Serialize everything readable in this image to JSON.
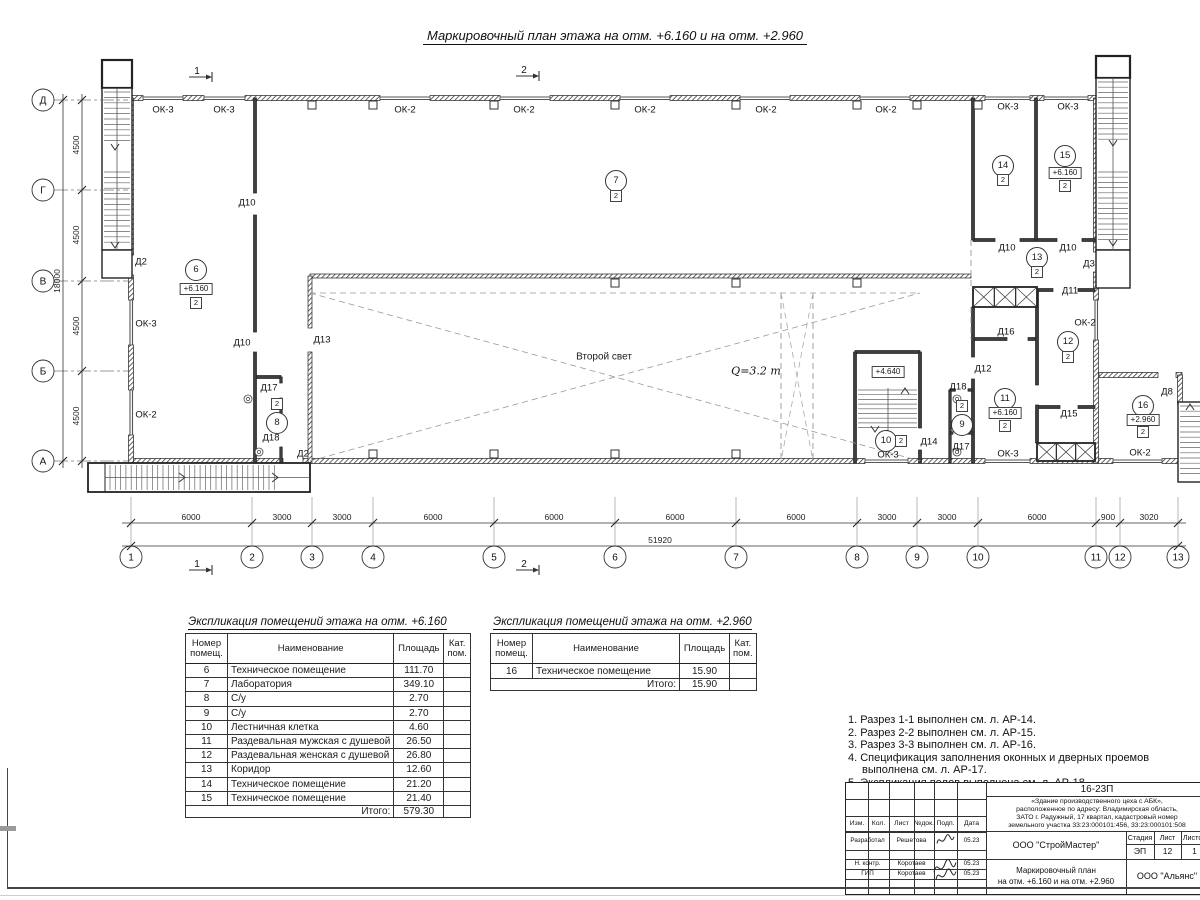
{
  "title": "Маркировочный план этажа на отм. +6.160 и на отм. +2.960",
  "plan": {
    "axes_letters": [
      {
        "label": "Д",
        "y": 100
      },
      {
        "label": "Г",
        "y": 190
      },
      {
        "label": "В",
        "y": 281
      },
      {
        "label": "Б",
        "y": 371
      },
      {
        "label": "А",
        "y": 461
      }
    ],
    "axes_numbers": [
      {
        "label": "1",
        "x": 131
      },
      {
        "label": "2",
        "x": 252
      },
      {
        "label": "3",
        "x": 312
      },
      {
        "label": "4",
        "x": 373
      },
      {
        "label": "5",
        "x": 494
      },
      {
        "label": "6",
        "x": 615
      },
      {
        "label": "7",
        "x": 736
      },
      {
        "label": "8",
        "x": 857
      },
      {
        "label": "9",
        "x": 917
      },
      {
        "label": "10",
        "x": 978
      },
      {
        "label": "11",
        "x": 1096
      },
      {
        "label": "12",
        "x": 1120
      },
      {
        "label": "13",
        "x": 1178
      }
    ],
    "h_dims": [
      {
        "label": "6000",
        "x": 191
      },
      {
        "label": "3000",
        "x": 282
      },
      {
        "label": "3000",
        "x": 342
      },
      {
        "label": "6000",
        "x": 433
      },
      {
        "label": "6000",
        "x": 554
      },
      {
        "label": "6000",
        "x": 675
      },
      {
        "label": "6000",
        "x": 796
      },
      {
        "label": "3000",
        "x": 887
      },
      {
        "label": "3000",
        "x": 947
      },
      {
        "label": "6000",
        "x": 1037
      },
      {
        "label": "900",
        "x": 1108
      },
      {
        "label": "3020",
        "x": 1149
      }
    ],
    "total_dim": "51920",
    "v_dims": [
      {
        "label": "4500",
        "y": 145
      },
      {
        "label": "4500",
        "y": 235
      },
      {
        "label": "4500",
        "y": 326
      },
      {
        "label": "4500",
        "y": 416
      }
    ],
    "total_v_dim": "18000",
    "section_marks": [
      {
        "label": "1",
        "x": 197,
        "y": 71
      },
      {
        "label": "2",
        "x": 524,
        "y": 70
      },
      {
        "label": "1",
        "x": 197,
        "y": 564
      },
      {
        "label": "2",
        "x": 524,
        "y": 564
      }
    ],
    "window_labels": [
      {
        "text": "ОК-3",
        "x": 163,
        "y": 110
      },
      {
        "text": "ОК-3",
        "x": 224,
        "y": 110
      },
      {
        "text": "ОК-2",
        "x": 405,
        "y": 110
      },
      {
        "text": "ОК-2",
        "x": 524,
        "y": 110
      },
      {
        "text": "ОК-2",
        "x": 645,
        "y": 110
      },
      {
        "text": "ОК-2",
        "x": 766,
        "y": 110
      },
      {
        "text": "ОК-2",
        "x": 886,
        "y": 110
      },
      {
        "text": "ОК-3",
        "x": 1008,
        "y": 107
      },
      {
        "text": "ОК-3",
        "x": 1068,
        "y": 107
      },
      {
        "text": "ОК-3",
        "x": 146,
        "y": 324
      },
      {
        "text": "ОК-2",
        "x": 146,
        "y": 415
      },
      {
        "text": "ОК-3",
        "x": 888,
        "y": 455
      },
      {
        "text": "ОК-3",
        "x": 1008,
        "y": 454
      },
      {
        "text": "ОК-2",
        "x": 1140,
        "y": 453
      },
      {
        "text": "ОК-2",
        "x": 1085,
        "y": 323
      }
    ],
    "door_labels": [
      {
        "text": "Д2",
        "x": 141,
        "y": 262
      },
      {
        "text": "Д10",
        "x": 247,
        "y": 203
      },
      {
        "text": "Д10",
        "x": 242,
        "y": 343
      },
      {
        "text": "Д13",
        "x": 322,
        "y": 340
      },
      {
        "text": "Д17",
        "x": 269,
        "y": 388
      },
      {
        "text": "Д18",
        "x": 271,
        "y": 438
      },
      {
        "text": "Д2",
        "x": 303,
        "y": 454
      },
      {
        "text": "Д14",
        "x": 929,
        "y": 442
      },
      {
        "text": "Д18",
        "x": 958,
        "y": 387
      },
      {
        "text": "Д17",
        "x": 961,
        "y": 447
      },
      {
        "text": "Д12",
        "x": 983,
        "y": 369
      },
      {
        "text": "Д16",
        "x": 1006,
        "y": 332
      },
      {
        "text": "Д10",
        "x": 1007,
        "y": 248
      },
      {
        "text": "Д10",
        "x": 1068,
        "y": 248
      },
      {
        "text": "Д3",
        "x": 1089,
        "y": 264
      },
      {
        "text": "Д11",
        "x": 1070,
        "y": 291
      },
      {
        "text": "Д15",
        "x": 1069,
        "y": 414
      },
      {
        "text": "Д8",
        "x": 1167,
        "y": 392
      }
    ],
    "rooms": [
      {
        "num": "6",
        "x": 196,
        "y": 270,
        "elev": "+6.160",
        "elev_dy": 19,
        "cat": "2",
        "cat_dy": 33,
        "cat_dx": 0
      },
      {
        "num": "7",
        "x": 616,
        "y": 181,
        "cat": "2",
        "cat_dy": 15,
        "cat_dx": 0
      },
      {
        "num": "8",
        "x": 277,
        "y": 423,
        "cat": "2",
        "cat_dy": -19,
        "cat_dx": 0
      },
      {
        "num": "9",
        "x": 962,
        "y": 425,
        "cat": "2",
        "cat_dy": -19,
        "cat_dx": 0
      },
      {
        "num": "10",
        "x": 886,
        "y": 441,
        "cat": "2",
        "cat_dy": 0,
        "cat_dx": 15
      },
      {
        "num": "11",
        "x": 1005,
        "y": 399,
        "elev": "+6.160",
        "elev_dy": 14,
        "cat": "2",
        "cat_dy": 27,
        "cat_dx": 0
      },
      {
        "num": "12",
        "x": 1068,
        "y": 342,
        "cat": "2",
        "cat_dy": 15,
        "cat_dx": 0
      },
      {
        "num": "13",
        "x": 1037,
        "y": 258,
        "cat": "2",
        "cat_dy": 14,
        "cat_dx": 0
      },
      {
        "num": "14",
        "x": 1003,
        "y": 166,
        "cat": "2",
        "cat_dy": 14,
        "cat_dx": 0
      },
      {
        "num": "15",
        "x": 1065,
        "y": 156,
        "elev": "+6.160",
        "elev_dy": 17,
        "cat": "2",
        "cat_dy": 30,
        "cat_dx": 0
      },
      {
        "num": "16",
        "x": 1143,
        "y": 406,
        "elev": "+2.960",
        "elev_dy": 14,
        "cat": "2",
        "cat_dy": 26,
        "cat_dx": 0
      }
    ],
    "texts": [
      {
        "text": "Второй свет",
        "x": 604,
        "y": 357,
        "style": "plain"
      },
      {
        "text": "Q=3.2 т",
        "x": 756,
        "y": 371,
        "style": "serifit"
      },
      {
        "text": "+4.640",
        "x": 888,
        "y": 372,
        "style": "boxed"
      }
    ]
  },
  "table1": {
    "title": "Экспликация помещений этажа на отм. +6.160",
    "headers": [
      "Номер помещ.",
      "Наименование",
      "Площадь",
      "Кат. пом."
    ],
    "rows": [
      [
        "6",
        "Техническое помещение",
        "111.70",
        ""
      ],
      [
        "7",
        "Лаборатория",
        "349.10",
        ""
      ],
      [
        "8",
        "С/у",
        "2.70",
        ""
      ],
      [
        "9",
        "С/у",
        "2.70",
        ""
      ],
      [
        "10",
        "Лестничная клетка",
        "4.60",
        ""
      ],
      [
        "11",
        "Раздевальная мужская с душевой",
        "26.50",
        ""
      ],
      [
        "12",
        "Раздевальная женская с душевой",
        "26.80",
        ""
      ],
      [
        "13",
        "Коридор",
        "12.60",
        ""
      ],
      [
        "14",
        "Техническое помещение",
        "21.20",
        ""
      ],
      [
        "15",
        "Техническое помещение",
        "21.40",
        ""
      ]
    ],
    "total_label": "Итого:",
    "total_value": "579.30"
  },
  "table2": {
    "title": "Экспликация помещений этажа на отм. +2.960",
    "headers": [
      "Номер помещ.",
      "Наименование",
      "Площадь",
      "Кат. пом."
    ],
    "rows": [
      [
        "16",
        "Техническое помещение",
        "15.90",
        ""
      ]
    ],
    "total_label": "Итого:",
    "total_value": "15.90"
  },
  "notes": [
    "1. Разрез 1-1 выполнен см. л. АР-14.",
    "2. Разрез 2-2 выполнен см. л. АР-15.",
    "3. Разрез 3-3 выполнен см. л. АР-16.",
    "4. Спецификация заполнения оконных и дверных проемов выполнена см. л. АР-17.",
    "5. Экспликация полов выполнена см. л. АР-18."
  ],
  "titleblock": {
    "code": "16-23П",
    "object_desc_lines": [
      "«Здание производственного цеха с АБК»,",
      "расположенное по адресу: Владимирская область,",
      "ЗАТО г. Радужный, 17 квартал, кадастровый номер",
      "земельного участка 33:23:000101:456, 33:23:000101:508"
    ],
    "header_cells": [
      "Изм.",
      "Кол.",
      "Лист",
      "№док.",
      "Подп.",
      "Дата"
    ],
    "sig_rows": [
      {
        "role": "Разработал",
        "name": "Решетова",
        "date": "05.23"
      },
      {
        "role": "Н. контр.",
        "name": "Коротаев",
        "date": "05.23"
      },
      {
        "role": "ГИП",
        "name": "Коротаев",
        "date": "05.23"
      }
    ],
    "org1": "ООО \"СтройМастер\"",
    "stage_label": "Стадия",
    "sheet_label": "Лист",
    "sheets_label": "Листов",
    "stage": "ЭП",
    "sheet": "12",
    "sheets": "1",
    "doc_title_lines": [
      "Маркировочный план",
      "на отм. +6.160 и на отм. +2.960"
    ],
    "org2": "ООО \"Альянс\""
  }
}
